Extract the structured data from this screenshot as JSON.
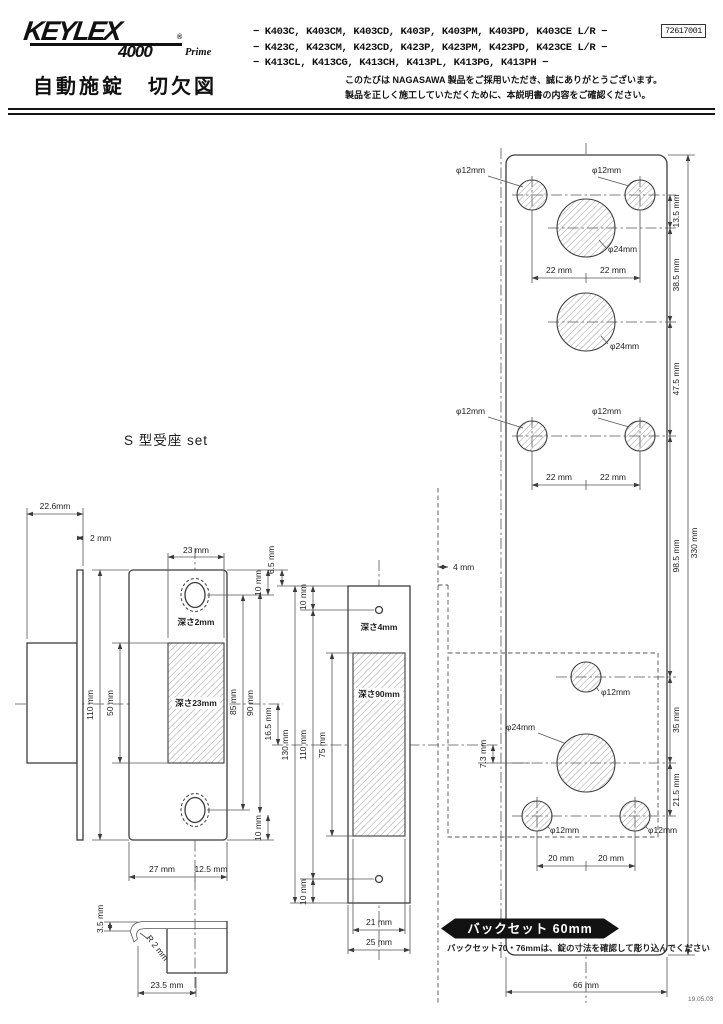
{
  "header": {
    "logo": {
      "brand": "KEYLEX",
      "series": "4000",
      "reg": "®",
      "suffix": "Prime"
    },
    "doc_number": "72617001",
    "model_lines": [
      "− K403C, K403CM, K403CD, K403P, K403PM, K403PD, K403CE L/R −",
      "− K423C, K423CM, K423CD, K423P, K423PM, K423PD, K423CE L/R −",
      "− K413CL, K413CG, K413CH, K413PL, K413PG, K413PH −"
    ],
    "title": "自動施錠　切欠図",
    "greeting1": "このたびは NAGASAWA 製品をご採用いただき、誠にありがとうございます。",
    "greeting2": "製品を正しく施工していただくために、本説明書の内容をご確認ください。"
  },
  "common": {
    "dim10": "10 mm"
  },
  "strike": {
    "label": "S 型受座 set",
    "overall_depth": "22.6mm",
    "plate_thickness": "2 mm",
    "pocket_width": "23 mm",
    "hole_depth": "深さ2mm",
    "pocket_depth": "深さ23mm",
    "plate_height": "110 mm",
    "pocket_height": "50 mm",
    "hole_pitch": "85 mm",
    "dim90": "90 mm",
    "offset_top": "6.5 mm",
    "offset_center": "16.5 mm",
    "width_left": "27 mm",
    "width_right": "12.5 mm",
    "lip_height": "3.5 mm",
    "lip_radius": "R 2 mm",
    "box_width": "23.5 mm"
  },
  "edge": {
    "screw_depth": "深さ4mm",
    "mortise_depth": "深さ90mm",
    "overall_height": "130 mm",
    "screw_pitch": "110 mm",
    "mortise_height": "75 mm",
    "mortise_width": "21 mm",
    "plate_width": "25 mm"
  },
  "face": {
    "d12": "φ12mm",
    "d24": "φ24mm",
    "pitch22": "22 mm",
    "pitch20": "20 mm",
    "dim13_5": "13.5 mm",
    "dim38_5": "38.5 mm",
    "dim47_5": "47.5 mm",
    "dim98_5": "98.5 mm",
    "dim35": "35 mm",
    "dim21_5": "21.5 mm",
    "dim330": "330 mm",
    "dim4": "4 mm",
    "dim7_3": "7.3 mm",
    "dim66": "66 mm"
  },
  "backset": {
    "badge": "バックセット 60mm",
    "note": "バックセット70・76mmは、錠の寸法を確認して彫り込んでください"
  },
  "date_code": "19.05.03"
}
